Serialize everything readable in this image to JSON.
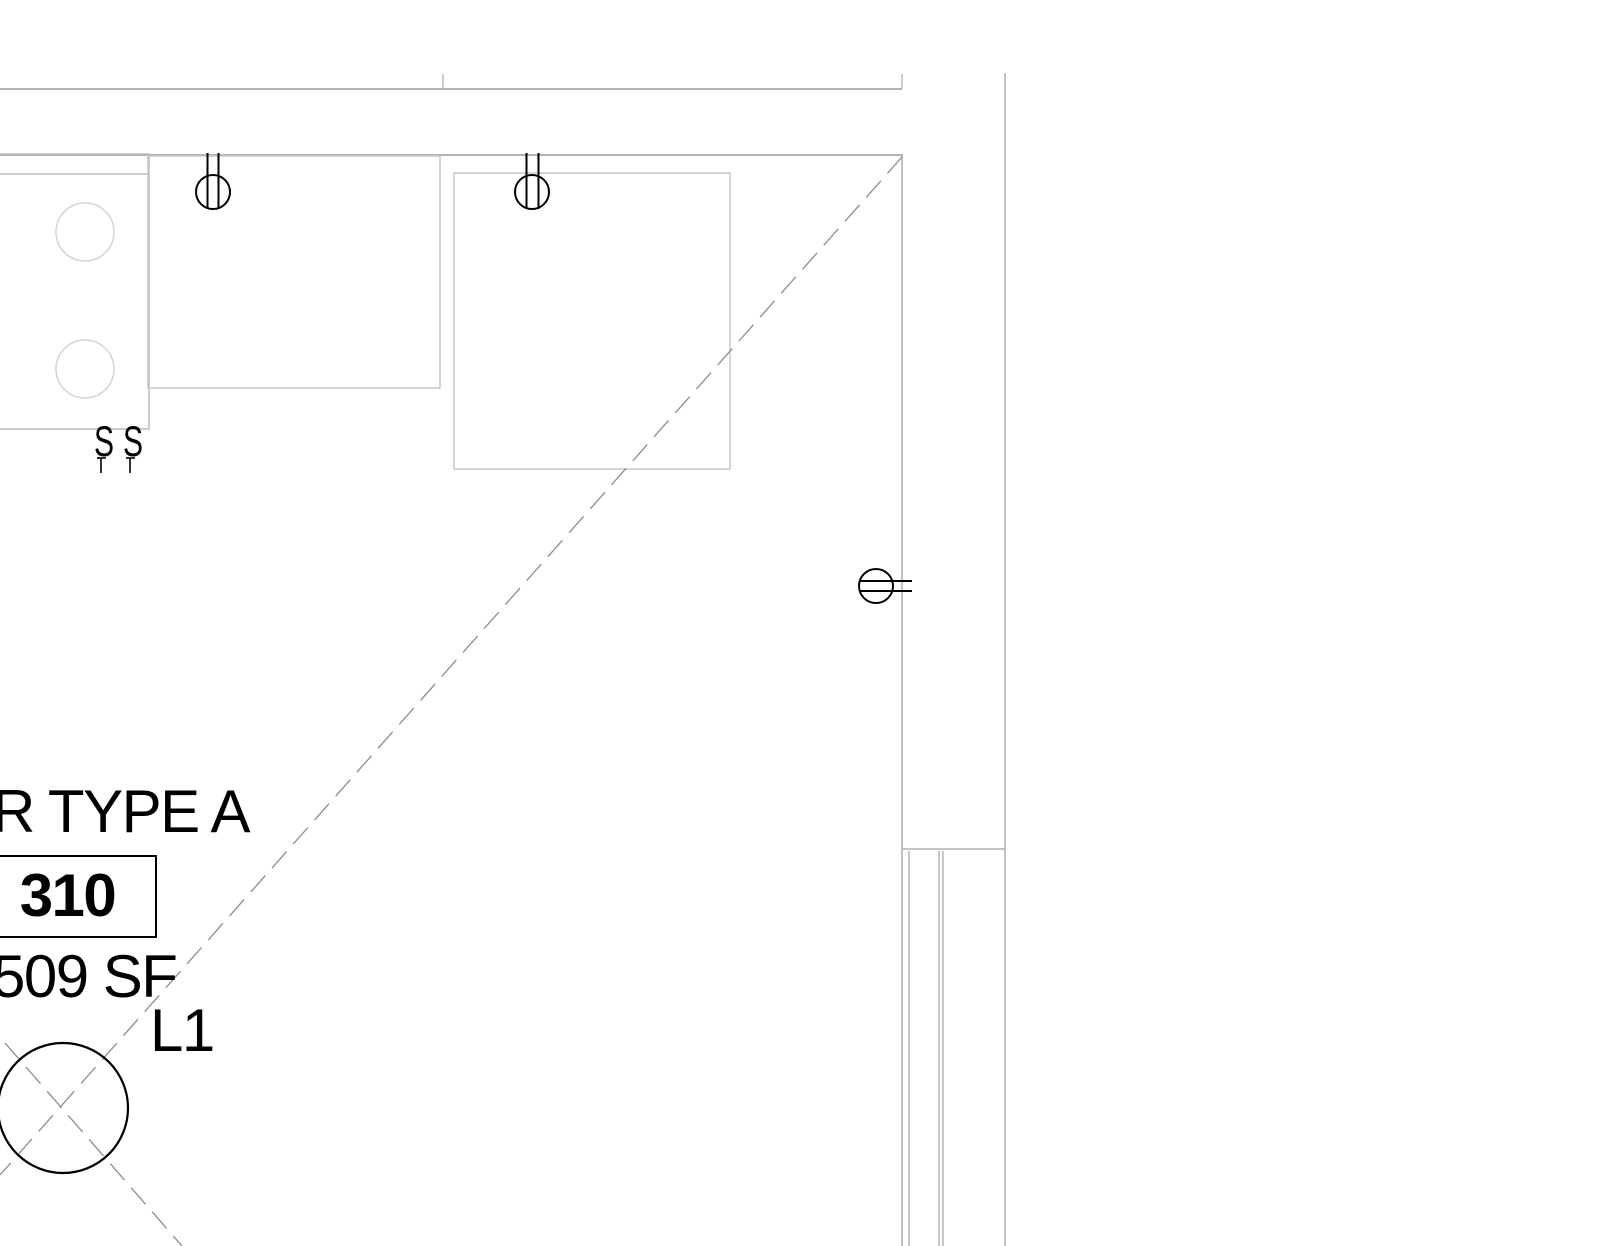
{
  "floor_plan": {
    "room": {
      "type_label": "R TYPE A",
      "number": "310",
      "area": "509 SF"
    },
    "lighting": {
      "fixture_label": "L1",
      "switch_symbol": "S"
    },
    "colors": {
      "wall_line": "#b0b2b4",
      "frame_line": "#a9abad",
      "cabinet_line": "#c5c7c9",
      "appliance_line": "#b9bbbd",
      "appliance_detail_line": "#d1d3d5",
      "dashed_line": "#8c8c8c",
      "symbol_line": "#000000",
      "text": "#000000",
      "background": "#ffffff"
    }
  }
}
